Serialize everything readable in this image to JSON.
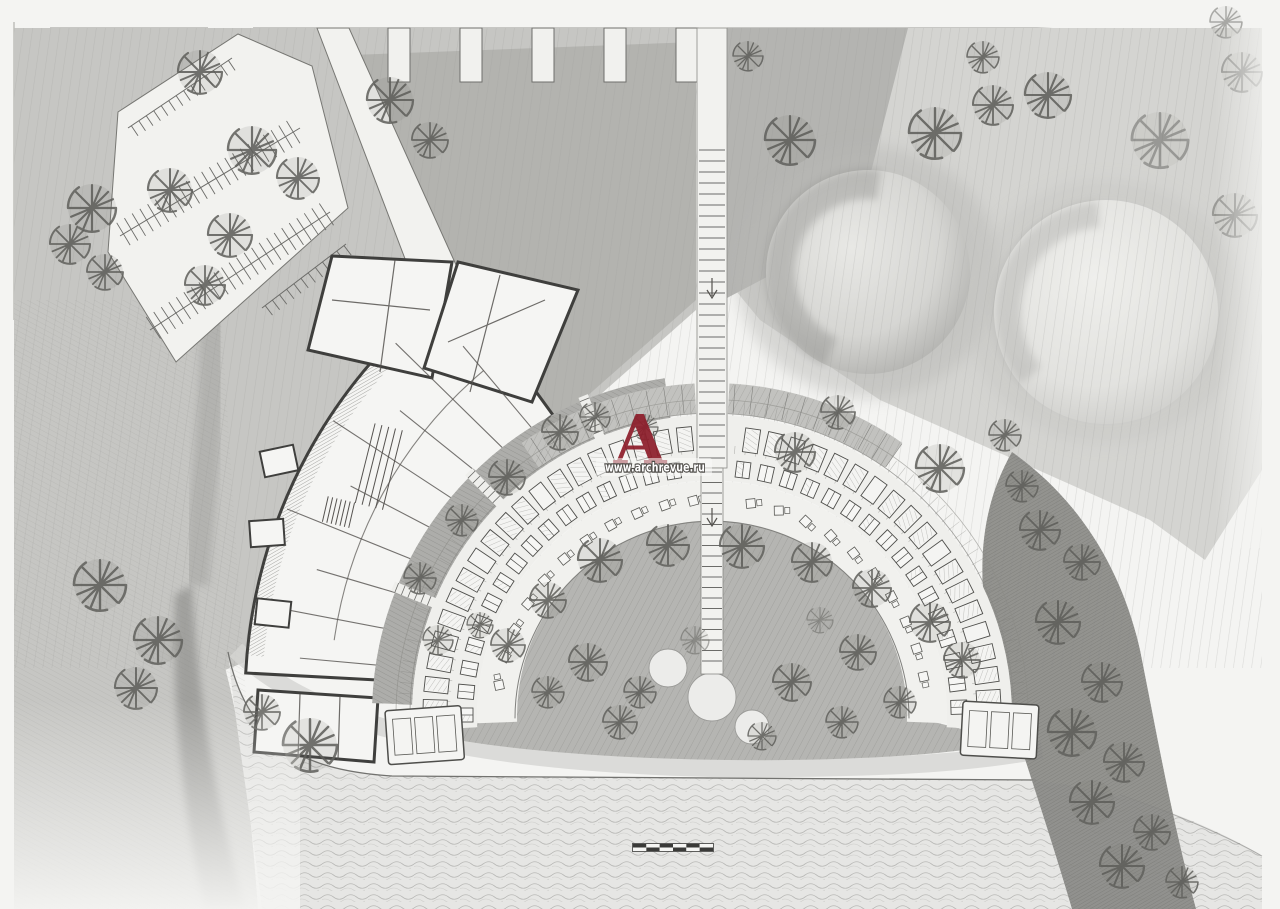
{
  "watermark": {
    "logo_letter": "A",
    "logo_color": "#8e1f2c",
    "url_text": "www.archrevue.ru",
    "url_text_color": "#ffffff",
    "url_outline_color": "#504e4a"
  },
  "scale_bar": {
    "segments": 6,
    "dark_color": "#3a3a38",
    "light_color": "#f6f6f4"
  },
  "palette": {
    "paper": "#f4f4f2",
    "grass_light": "#d4d4d1",
    "grass_mid": "#c6c6c3",
    "grass_dark": "#b0b0ad",
    "courtyard": "#adadaa",
    "forest_dark": "#8a8a87",
    "water": "#e6e6e4",
    "wall_line": "#3f3f3d",
    "pencil_line": "#6f6f6c",
    "logo_red": "#8e1f2c"
  }
}
